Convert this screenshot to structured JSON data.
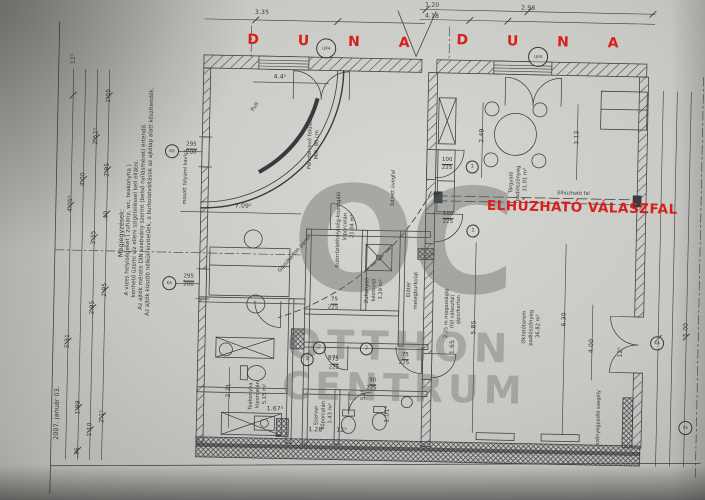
{
  "palette": {
    "paper": "#c9cac5",
    "ink": "#34373a",
    "red": "#d81f1a",
    "watermark": "#62645f"
  },
  "annotations": {
    "site_label_left": "D U N A",
    "site_label_right": "D U N A",
    "partition": "ELHÚZHATÓ VÁLASZFAL",
    "partition_small": "Elhúzható fal",
    "date": "2007. január 03.",
    "watermark": "OC OTTHON CENTRUM",
    "surface_note": "mosott folyami kavics",
    "glass_note": "Edzett üvegfal",
    "counter": "Pult",
    "panel_note": "Gipszkarton panel"
  },
  "notes": {
    "title": "Megjegyzések:",
    "lines": [
      "A vizes helyiségeket ( zuhany, wc, teakonyha )",
      "kenhető üzemi víz elleni szigeteléssel kell ellátni.",
      "Az ajtók mérete DIN szabvány szerint (belső nyílásméret) értendő.",
      "Az ajtók küszöb nélküli kivitelűek, a burkolatváltások az ajtólap alatt készítendők."
    ]
  },
  "rooms": [
    {
      "name": "Bútorüzlethelyiség-kiszolgáló",
      "floor": "klporcelán",
      "area": "21.04 m²"
    },
    {
      "name": "Zuhanyzó-kézmosó",
      "floor": "klporcelán",
      "area": "3.29 m²"
    },
    {
      "name": "Teakonyha",
      "floor": "klporcelán",
      "area": "5.15 m²"
    },
    {
      "name": "Szerver",
      "floor": "köporcelán",
      "area": "1.43 m²"
    },
    {
      "name": "Előtér",
      "floor": "melegburkolat",
      "area": ""
    },
    {
      "name": "Tárgyaló",
      "floor": "padlószőnyeg",
      "area": "31.01 m²"
    },
    {
      "name": "Oktatóterem",
      "floor": "padlószőnyeg",
      "area": "36.82 m²"
    }
  ],
  "labels": [
    {
      "t": "OC",
      "c": "wm1",
      "x": 292,
      "y": 168,
      "n": "watermark-oc"
    },
    {
      "t": "OTTHON",
      "c": "wm2",
      "x": 289,
      "y": 326,
      "n": "watermark-otthon"
    },
    {
      "t": "CENTRUM",
      "c": "wm3",
      "x": 285,
      "y": 368,
      "n": "watermark-centrum"
    },
    {
      "t": "D U N A",
      "c": "redsite",
      "x": 243,
      "y": 35,
      "n": "duna-label-left"
    },
    {
      "t": "D U N A",
      "c": "redsite",
      "x": 452,
      "y": 31,
      "n": "duna-label-right"
    },
    {
      "t": "ELHÚZHATÓ VÁLASZFAL",
      "c": "redbig",
      "x": 486,
      "y": 197,
      "n": "sliding-partition-label"
    },
    {
      "t": "Elhúzható fal",
      "c": "tiny",
      "x": 556,
      "y": 187,
      "n": "sliding-partition-small-label"
    },
    {
      "t": "mosott folyami kavics",
      "c": "tiny",
      "x": 182,
      "y": 208,
      "r": -90
    },
    {
      "t": "Edzett üvegfal",
      "c": "tiny",
      "x": 390,
      "y": 205,
      "r": -90
    },
    {
      "t": "2007. január 03.",
      "c": "note",
      "x": 57,
      "y": 446,
      "r": -90,
      "n": "date-note"
    },
    {
      "t": "Megjegyzések:",
      "c": "note",
      "x": 118,
      "y": 262,
      "r": -90,
      "n": "notes-title"
    },
    {
      "t": "A vizes helyiségeket ( zuhany, wc, teakonyha )",
      "c": "note2",
      "x": 126,
      "y": 300,
      "r": -90
    },
    {
      "t": "kenhető üzemi víz elleni szigeteléssel kell ellátni.",
      "c": "note2",
      "x": 133,
      "y": 302,
      "r": -90
    },
    {
      "t": "Az ajtók mérete DIN szabvány szerint (belső nyílásméret) értendő.",
      "c": "note2",
      "x": 140,
      "y": 314,
      "r": -90
    },
    {
      "t": "Az ajtók küszöb nélküli kivitelűek, a burkolatváltások az ajtólap alatt készítendők.",
      "c": "note2",
      "x": 147,
      "y": 320,
      "r": -90
    },
    {
      "t": "Bútorüzlethelyiség-kiszolgáló",
      "c": "room",
      "x": 336,
      "y": 268,
      "r": -90
    },
    {
      "t": "klporcelán",
      "c": "room",
      "x": 343,
      "y": 240,
      "r": -90
    },
    {
      "t": "21.04 m²",
      "c": "room",
      "x": 350,
      "y": 238,
      "r": -90
    },
    {
      "t": "Zuhanyzó",
      "c": "room",
      "x": 366,
      "y": 303,
      "r": -90
    },
    {
      "t": "kézmosó",
      "c": "room",
      "x": 373,
      "y": 301,
      "r": -90
    },
    {
      "t": "3.29 m²",
      "c": "room",
      "x": 380,
      "y": 299,
      "r": -90
    },
    {
      "t": "Teakonyha",
      "c": "room",
      "x": 252,
      "y": 412,
      "r": -90
    },
    {
      "t": "klporcelán",
      "c": "room",
      "x": 259,
      "y": 410,
      "r": -90
    },
    {
      "t": "5.15 m²",
      "c": "room",
      "x": 266,
      "y": 406,
      "r": -90
    },
    {
      "t": "Szerver",
      "c": "room",
      "x": 318,
      "y": 426,
      "r": -90
    },
    {
      "t": "köporcelán",
      "c": "room",
      "x": 325,
      "y": 430,
      "r": -90
    },
    {
      "t": "1.43 m²",
      "c": "room",
      "x": 332,
      "y": 424,
      "r": -90
    },
    {
      "t": "Előtér",
      "c": "room",
      "x": 408,
      "y": 296,
      "r": -90
    },
    {
      "t": "melegburkolat",
      "c": "room",
      "x": 415,
      "y": 308,
      "r": -90
    },
    {
      "t": "Tárgyaló",
      "c": "room",
      "x": 508,
      "y": 190,
      "r": -90
    },
    {
      "t": "padlószőnyeg",
      "c": "room",
      "x": 515,
      "y": 198,
      "r": -90
    },
    {
      "t": "31.01 m²",
      "c": "room",
      "x": 522,
      "y": 188,
      "r": -90
    },
    {
      "t": "Oktatóterem",
      "c": "room",
      "x": 524,
      "y": 340,
      "r": -90
    },
    {
      "t": "padlószőnyeg",
      "c": "room",
      "x": 531,
      "y": 342,
      "r": -90
    },
    {
      "t": "36.82 m²",
      "c": "room",
      "x": 538,
      "y": 334,
      "r": -90
    },
    {
      "t": "Pult",
      "c": "room",
      "x": 248,
      "y": 112,
      "r": -58
    },
    {
      "t": "Gipszkarton panel",
      "c": "room",
      "x": 278,
      "y": 272,
      "r": -50
    },
    {
      "t": "Pénzfelvevő felület",
      "c": "room",
      "x": 306,
      "y": 170,
      "r": -90
    },
    {
      "t": "Mfé: 90 cm",
      "c": "room",
      "x": 313,
      "y": 160,
      "r": -90
    },
    {
      "t": "2.25 m magasságig",
      "c": "tiny",
      "x": 446,
      "y": 336,
      "r": -90
    },
    {
      "t": "(fél válaszfal)",
      "c": "tiny",
      "x": 452,
      "y": 326,
      "r": -90
    },
    {
      "t": "gipszkarton",
      "c": "tiny",
      "x": 458,
      "y": 322,
      "r": -90
    },
    {
      "t": "szőnyegpadló szegély",
      "c": "tiny",
      "x": 600,
      "y": 440,
      "r": -90
    },
    {
      "t": "12⁵",
      "c": "dim",
      "x": 67,
      "y": 70,
      "r": -90
    },
    {
      "t": "1.05",
      "c": "dim",
      "x": 103,
      "y": 108,
      "r": -90
    },
    {
      "t": "2.52⁵",
      "c": "dim",
      "x": 91,
      "y": 150,
      "r": -90
    },
    {
      "t": "2.95",
      "c": "dim",
      "x": 103,
      "y": 182,
      "r": -90
    },
    {
      "t": "4.00",
      "c": "dim",
      "x": 79,
      "y": 192,
      "r": -90
    },
    {
      "t": "4.05⁵",
      "c": "dim",
      "x": 67,
      "y": 218,
      "r": -90
    },
    {
      "t": "3.35",
      "c": "dim",
      "x": 91,
      "y": 250,
      "r": -90
    },
    {
      "t": ".40",
      "c": "dim",
      "x": 103,
      "y": 226,
      "r": -90
    },
    {
      "t": "2.95",
      "c": "dim",
      "x": 103,
      "y": 302,
      "r": -90
    },
    {
      "t": "2.95",
      "c": "dim",
      "x": 91,
      "y": 320,
      "r": -90
    },
    {
      "t": "5.31",
      "c": "dim",
      "x": 67,
      "y": 354,
      "r": -90
    },
    {
      "t": "1.98",
      "c": "dim",
      "x": 79,
      "y": 420,
      "r": -90
    },
    {
      "t": "2.1⁵",
      "c": "dim",
      "x": 103,
      "y": 428,
      "r": -90
    },
    {
      "t": "1.10",
      "c": "dim",
      "x": 91,
      "y": 442,
      "r": -90
    },
    {
      "t": ".36",
      "c": "dim",
      "x": 79,
      "y": 463,
      "r": -90
    },
    {
      "t": "3.35",
      "c": "dim",
      "x": 250,
      "y": 12
    },
    {
      "t": "1.20",
      "c": "dim",
      "x": 420,
      "y": 1
    },
    {
      "t": "4.18",
      "c": "dim",
      "x": 420,
      "y": 12
    },
    {
      "t": "2.98",
      "c": "dim",
      "x": 516,
      "y": 2
    },
    {
      "t": "4.4⁵",
      "c": "dim",
      "x": 270,
      "y": 76
    },
    {
      "t": "7.09⁵",
      "c": "dim",
      "x": 234,
      "y": 206
    },
    {
      "t": "2.49",
      "c": "dim",
      "x": 477,
      "y": 140,
      "r": -90
    },
    {
      "t": "3.13",
      "c": "dim",
      "x": 572,
      "y": 140,
      "r": -90
    },
    {
      "t": "5.85",
      "c": "dim",
      "x": 473,
      "y": 332,
      "r": -90
    },
    {
      "t": "6.30",
      "c": "dim",
      "x": 563,
      "y": 322,
      "r": -90
    },
    {
      "t": "4.00",
      "c": "dim",
      "x": 591,
      "y": 348,
      "r": -90
    },
    {
      "t": "5.00",
      "c": "dim",
      "x": 685,
      "y": 330,
      "r": -90
    },
    {
      "t": "2.21",
      "c": "dim",
      "x": 229,
      "y": 400,
      "r": -90
    },
    {
      "t": "1.67⁵",
      "c": "dim",
      "x": 270,
      "y": 408
    },
    {
      "t": "1.28",
      "c": "dim",
      "x": 312,
      "y": 428
    },
    {
      "t": "12⁵",
      "c": "dim",
      "x": 340,
      "y": 428
    },
    {
      "t": "87⁵",
      "c": "dim",
      "x": 330,
      "y": 356
    },
    {
      "t": "52⁵",
      "c": "dim",
      "x": 364,
      "y": 400,
      "r": -90
    },
    {
      "t": "1.01⁵",
      "c": "dim",
      "x": 388,
      "y": 422,
      "r": -90
    },
    {
      "t": "1.65",
      "c": "dim",
      "x": 452,
      "y": 352,
      "r": -90
    },
    {
      "t": "12⁵",
      "c": "dim",
      "x": 620,
      "y": 352,
      "r": -90
    },
    {
      "t": "75",
      "c": "fnum",
      "x": 332,
      "y": 298
    },
    {
      "t": "225",
      "c": "fden",
      "x": 329,
      "y": 306
    },
    {
      "t": "75",
      "c": "fnum",
      "x": 334,
      "y": 358
    },
    {
      "t": "225",
      "c": "fden",
      "x": 331,
      "y": 366
    },
    {
      "t": "75",
      "c": "fnum",
      "x": 404,
      "y": 352
    },
    {
      "t": "225",
      "c": "fden",
      "x": 401,
      "y": 360
    },
    {
      "t": "90",
      "c": "fnum",
      "x": 372,
      "y": 378
    },
    {
      "t": "225",
      "c": "fden",
      "x": 369,
      "y": 386
    },
    {
      "t": "100",
      "c": "fnum",
      "x": 440,
      "y": 156
    },
    {
      "t": "225",
      "c": "fden",
      "x": 440,
      "y": 164
    },
    {
      "t": "100",
      "c": "fnum",
      "x": 442,
      "y": 210
    },
    {
      "t": "225",
      "c": "fden",
      "x": 442,
      "y": 218
    },
    {
      "t": "295",
      "c": "fnum",
      "x": 184,
      "y": 278
    },
    {
      "t": "200",
      "c": "fden",
      "x": 184,
      "y": 286
    },
    {
      "t": "295",
      "c": "fnum",
      "x": 184,
      "y": 146
    },
    {
      "t": "200",
      "c": "fden",
      "x": 184,
      "y": 154
    },
    {
      "t": "2",
      "c": "circ",
      "x": 315,
      "y": 342
    },
    {
      "t": "3",
      "c": "circ",
      "x": 303,
      "y": 354
    },
    {
      "t": "2",
      "c": "circ",
      "x": 362,
      "y": 342
    },
    {
      "t": "1",
      "c": "circ",
      "x": 464,
      "y": 158
    },
    {
      "t": "1",
      "c": "circ",
      "x": 466,
      "y": 222
    },
    {
      "t": "K6",
      "c": "circ2",
      "x": 163,
      "y": 280
    },
    {
      "t": "K6",
      "c": "circ2",
      "x": 163,
      "y": 148
    },
    {
      "t": "K4",
      "c": "circ2",
      "x": 652,
      "y": 330
    },
    {
      "t": "F4",
      "c": "circ2",
      "x": 682,
      "y": 414
    },
    {
      "t": "LJK4",
      "c": "circ3",
      "x": 312,
      "y": 39
    },
    {
      "t": "LJK4",
      "c": "circ3",
      "x": 524,
      "y": 43
    }
  ]
}
